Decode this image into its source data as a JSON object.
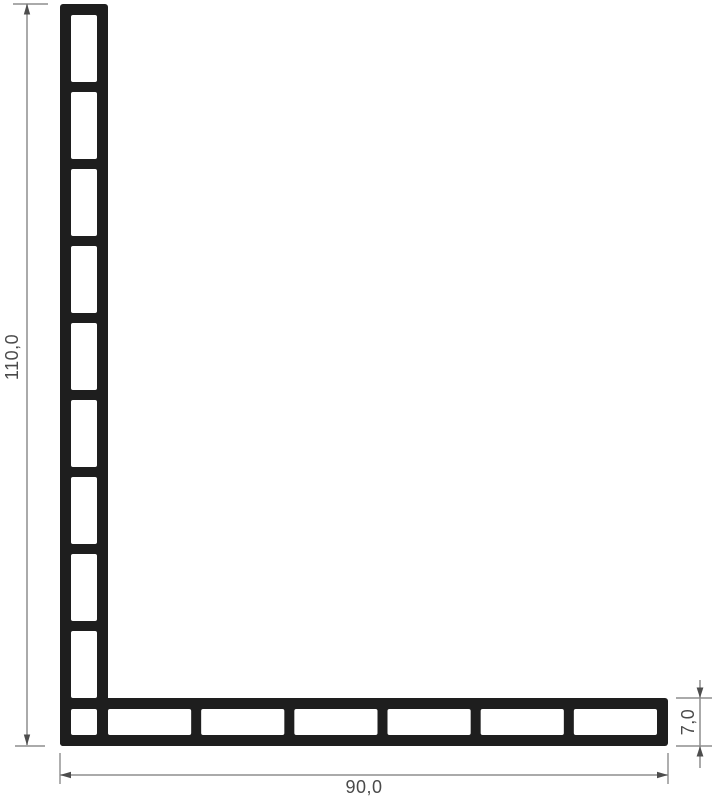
{
  "drawing": {
    "title": "L-angle multi-chamber profile cross-section",
    "dimensions": {
      "height": {
        "label": "110,0",
        "orientation": "vertical"
      },
      "width": {
        "label": "90,0",
        "orientation": "horizontal"
      },
      "thickness": {
        "label": "7,0",
        "orientation": "vertical"
      }
    },
    "profile": {
      "vertical_leg_chambers": 9,
      "horizontal_leg_chambers": 6,
      "corner_chambers": 1
    },
    "colors": {
      "background": "#ffffff",
      "profile": "#1e1e1e",
      "chamber_fill": "#ffffff",
      "dimension_line": "#8d8d8d",
      "arrow": "#4d4d4d",
      "text": "#4a4a4a"
    }
  }
}
